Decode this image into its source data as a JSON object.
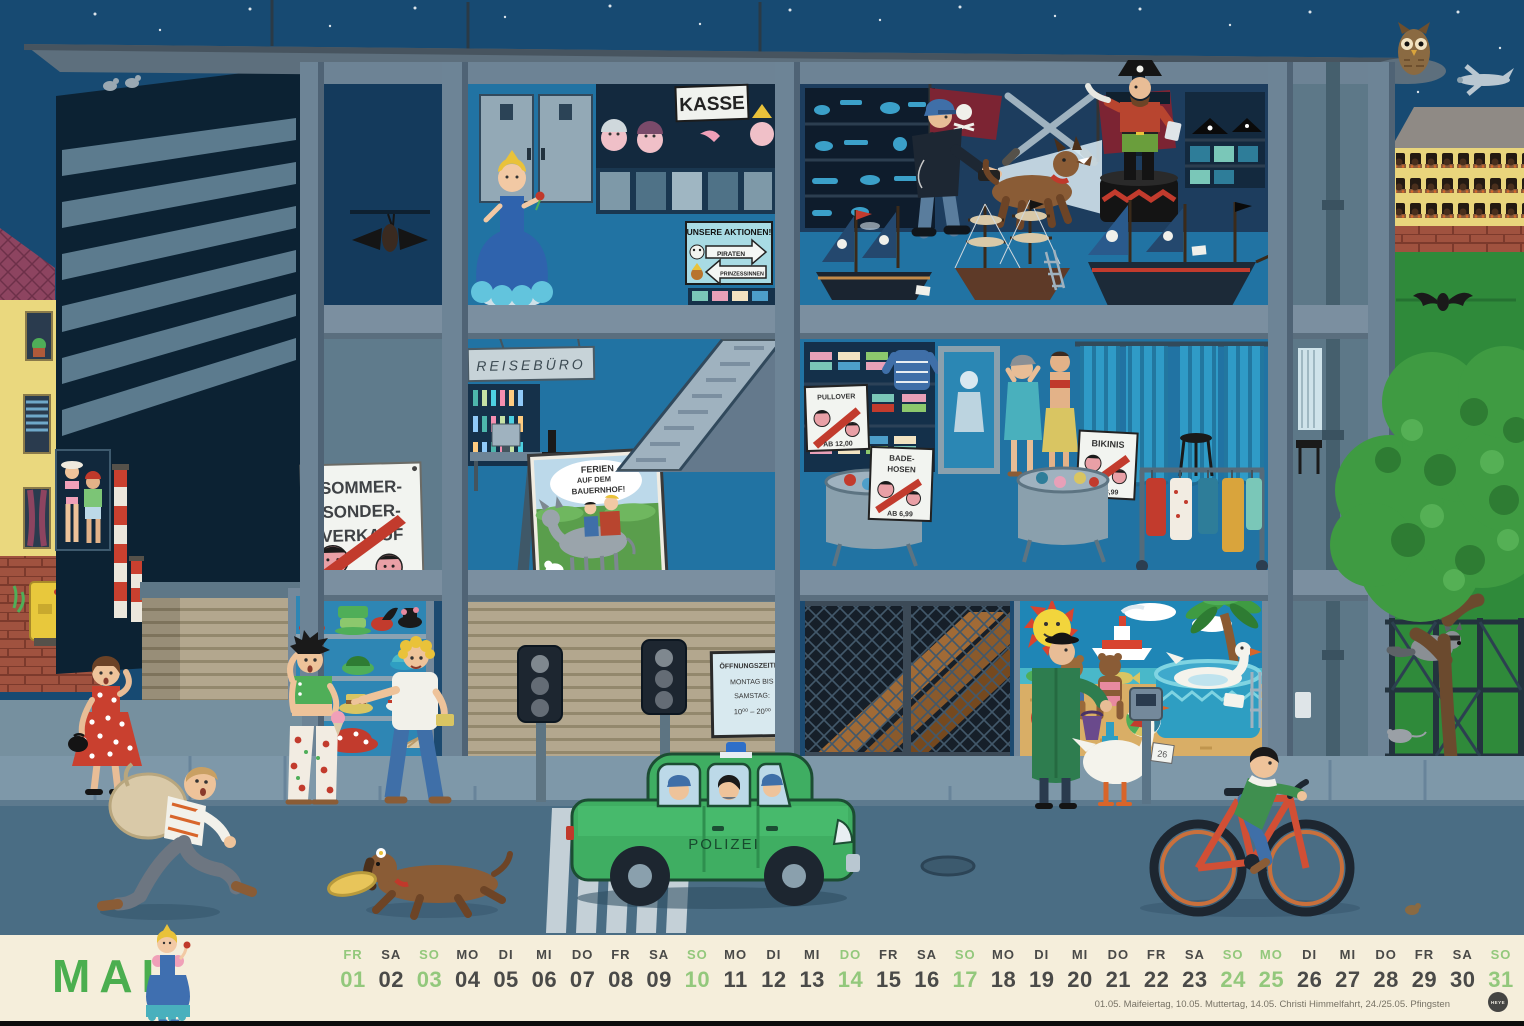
{
  "calendar": {
    "month": "MAI",
    "days": [
      {
        "weekday": "FR",
        "date": "01",
        "type": "highlight"
      },
      {
        "weekday": "SA",
        "date": "02",
        "type": "normal"
      },
      {
        "weekday": "SO",
        "date": "03",
        "type": "highlight"
      },
      {
        "weekday": "MO",
        "date": "04",
        "type": "normal"
      },
      {
        "weekday": "DI",
        "date": "05",
        "type": "normal"
      },
      {
        "weekday": "MI",
        "date": "06",
        "type": "normal"
      },
      {
        "weekday": "DO",
        "date": "07",
        "type": "normal"
      },
      {
        "weekday": "FR",
        "date": "08",
        "type": "normal"
      },
      {
        "weekday": "SA",
        "date": "09",
        "type": "normal"
      },
      {
        "weekday": "SO",
        "date": "10",
        "type": "highlight"
      },
      {
        "weekday": "MO",
        "date": "11",
        "type": "normal"
      },
      {
        "weekday": "DI",
        "date": "12",
        "type": "normal"
      },
      {
        "weekday": "MI",
        "date": "13",
        "type": "normal"
      },
      {
        "weekday": "DO",
        "date": "14",
        "type": "highlight"
      },
      {
        "weekday": "FR",
        "date": "15",
        "type": "normal"
      },
      {
        "weekday": "SA",
        "date": "16",
        "type": "normal"
      },
      {
        "weekday": "SO",
        "date": "17",
        "type": "highlight"
      },
      {
        "weekday": "MO",
        "date": "18",
        "type": "normal"
      },
      {
        "weekday": "DI",
        "date": "19",
        "type": "normal"
      },
      {
        "weekday": "MI",
        "date": "20",
        "type": "normal"
      },
      {
        "weekday": "DO",
        "date": "21",
        "type": "normal"
      },
      {
        "weekday": "FR",
        "date": "22",
        "type": "normal"
      },
      {
        "weekday": "SA",
        "date": "23",
        "type": "normal"
      },
      {
        "weekday": "SO",
        "date": "24",
        "type": "highlight"
      },
      {
        "weekday": "MO",
        "date": "25",
        "type": "highlight"
      },
      {
        "weekday": "DI",
        "date": "26",
        "type": "normal"
      },
      {
        "weekday": "MI",
        "date": "27",
        "type": "normal"
      },
      {
        "weekday": "DO",
        "date": "28",
        "type": "normal"
      },
      {
        "weekday": "FR",
        "date": "29",
        "type": "normal"
      },
      {
        "weekday": "SA",
        "date": "30",
        "type": "normal"
      },
      {
        "weekday": "SO",
        "date": "31",
        "type": "highlight"
      }
    ],
    "footnote": "01.05. Maifeiertag, 10.05. Muttertag, 14.05. Christi Himmelfahrt, 24./25.05. Pfingsten",
    "logo": "HEYE"
  },
  "scene": {
    "signs": {
      "kasse": "KASSE",
      "reiseburo": "REISEBÜRO",
      "aktionen_title": "UNSERE AKTIONEN!",
      "aktionen_piraten": "PIRATEN",
      "aktionen_prinzessinnen": "PRINZESSINNEN",
      "sommer_l1": "SOMMER-",
      "sommer_l2": "SONDER-",
      "sommer_l3": "VERKAUF",
      "ferien_l1": "FERIEN",
      "ferien_l2": "AUF DEM",
      "ferien_l3": "BAUERNHOF!",
      "pullover_title": "PULLOVER",
      "pullover_price": "AB 12,00",
      "badehosen_l1": "BADE-",
      "badehosen_l2": "HOSEN",
      "badehosen_price": "AB 6,99",
      "bikinis_title": "BIKINIS",
      "bikinis_price": "AB 8,99",
      "oeffnung_l1": "ÖFFNUNGSZEITEN",
      "oeffnung_l2": "MONTAG BIS",
      "oeffnung_l3": "SAMSTAG:",
      "oeffnung_l4": "10⁰⁰ – 20⁰⁰",
      "polizei": "POLIZEI",
      "meter_tag": "26"
    }
  },
  "colors": {
    "accent_green": "#93c87c",
    "month_green": "#4bae4f",
    "day_gray": "#4a4a48",
    "strip_bg": "#f5eedb",
    "sky": "#174a72",
    "police_car": "#3fae62"
  }
}
